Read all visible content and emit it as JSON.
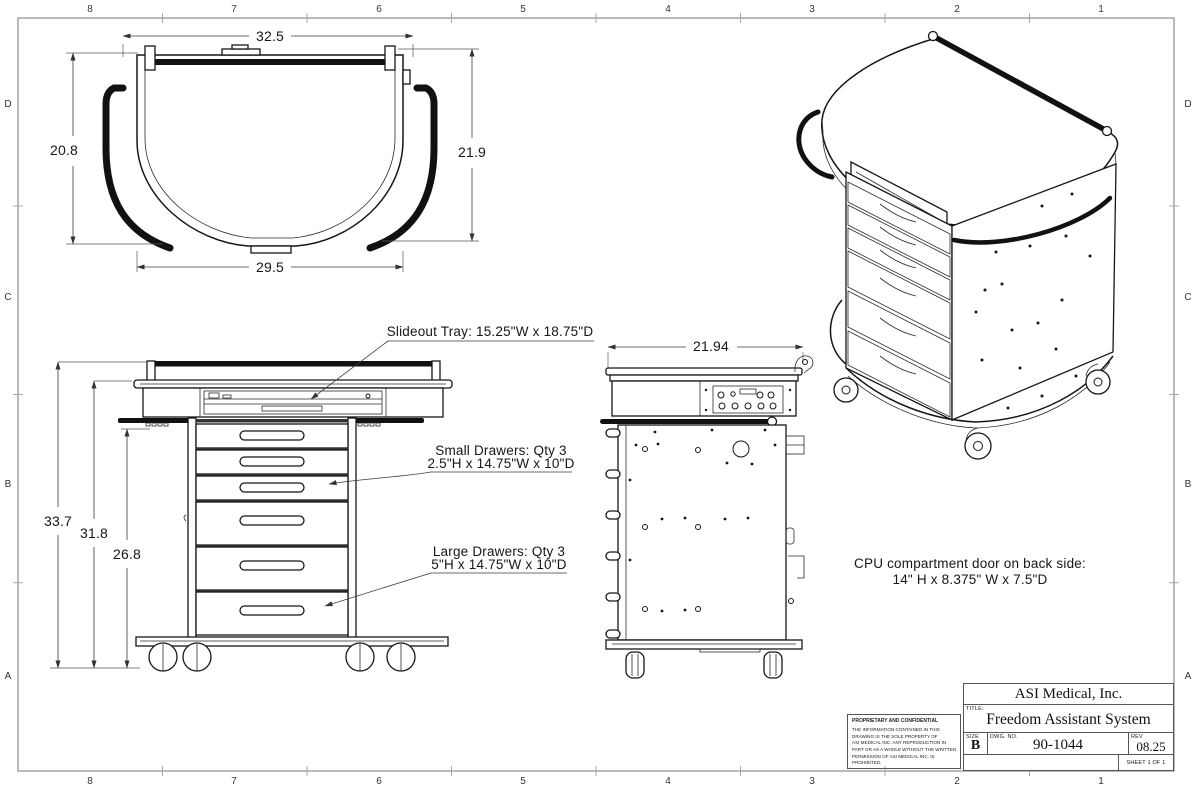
{
  "sheet": {
    "cols": [
      "8",
      "7",
      "6",
      "5",
      "4",
      "3",
      "2",
      "1"
    ],
    "rows": [
      "D",
      "C",
      "B",
      "A"
    ]
  },
  "top_view": {
    "width_top": "32.5",
    "height_left": "20.8",
    "height_right": "21.9",
    "width_bottom": "29.5"
  },
  "front_view": {
    "height_overall": "33.7",
    "height_mid": "31.8",
    "height_lower": "26.8"
  },
  "side_view": {
    "depth_top": "21.94"
  },
  "annotations": {
    "slideout_tray": "Slideout Tray: 15.25\"W x 18.75\"D",
    "small_drawers_line1": "Small Drawers: Qty 3",
    "small_drawers_line2": "2.5\"H x 14.75\"W x 10\"D",
    "large_drawers_line1": "Large Drawers: Qty 3",
    "large_drawers_line2": "5\"H x 14.75\"W x 10\"D",
    "cpu_line1": "CPU compartment door on back side:",
    "cpu_line2": "14\" H x 8.375\" W x 7.5\"D"
  },
  "title_block": {
    "company": "ASI Medical, Inc.",
    "title_label": "TITLE:",
    "title": "Freedom Assistant System",
    "size_label": "SIZE",
    "size": "B",
    "dwg_label": "DWG.  NO.",
    "dwg_no": "90-1044",
    "rev_label": "REV",
    "rev": "08.25",
    "sheet_of": "SHEET 1 OF 1",
    "proprietary_heading": "PROPRIETARY AND CONFIDENTIAL",
    "proprietary_body": "THE INFORMATION CONTAINED IN THIS\nDRAWING IS THE SOLE PROPERTY OF\nASI MEDICAL INC.  ANY REPRODUCTION IN\nPART OR AS A WHOLE WITHOUT THE WRITTEN\nPERMISSION OF ASI MEDICAL INC. IS PROHIBITED."
  }
}
